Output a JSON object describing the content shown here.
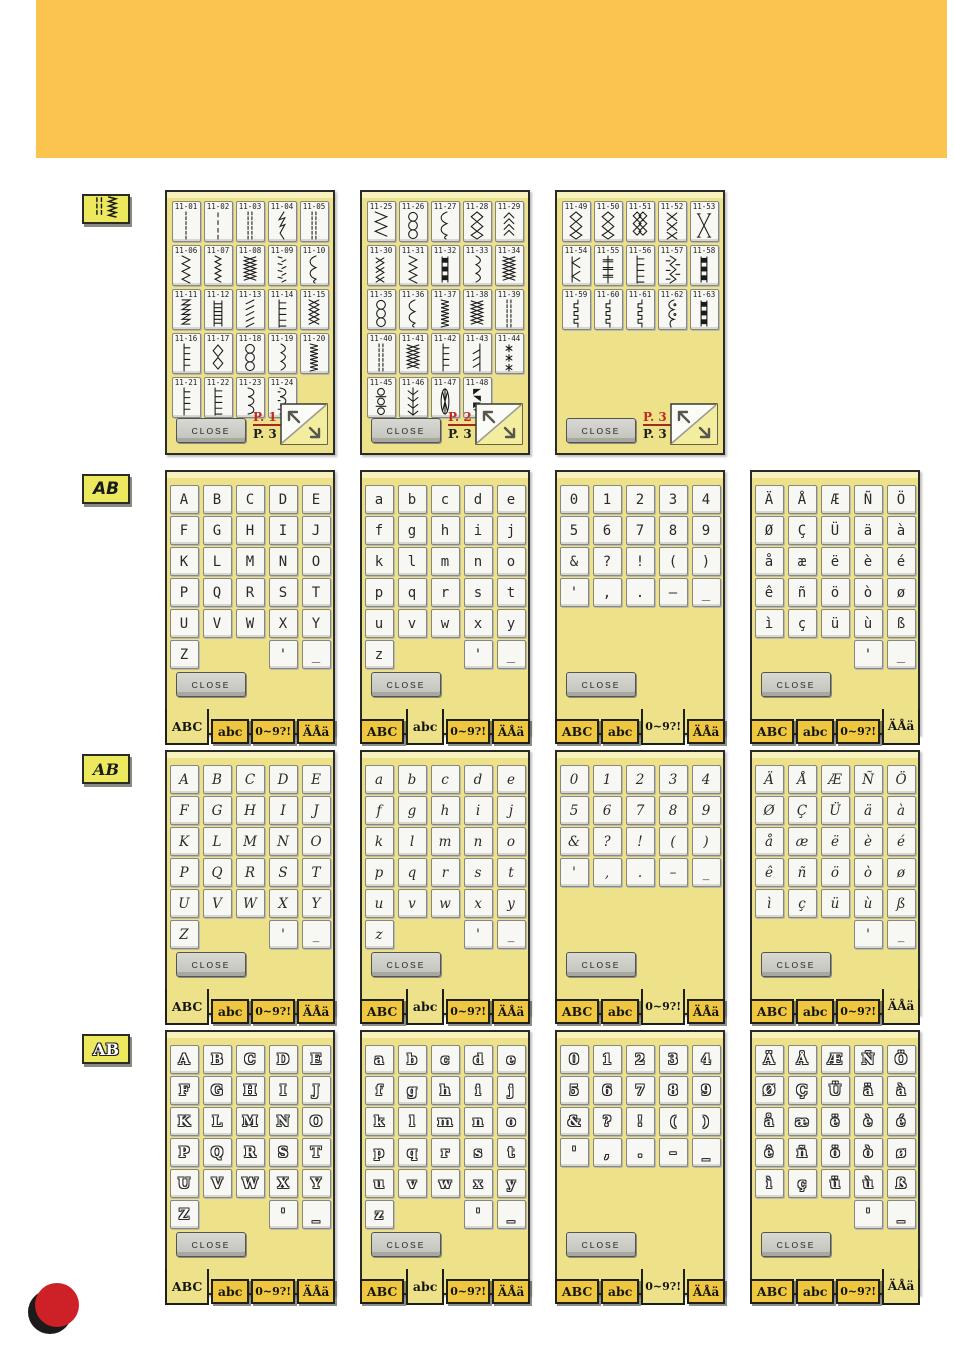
{
  "header": {
    "band_color": "#FAC44F"
  },
  "decoration": {
    "red_dot_color": "#CE2127",
    "shadow_dot_color": "#1d1b1a"
  },
  "common": {
    "close_label": "CLOSE",
    "tabs": [
      "ABC",
      "abc",
      "0~9?!",
      "ÄÅä"
    ],
    "page_total": "P. 3"
  },
  "sidebar": {
    "stitch_button_icon": "stitch-pattern-icon",
    "font_button_label": "AB"
  },
  "font_rows": [
    {
      "id": "block",
      "button_label": "AB"
    },
    {
      "id": "script",
      "button_label": "AB"
    },
    {
      "id": "outline",
      "button_label": "AB"
    }
  ],
  "panel_order": [
    "upper",
    "lower",
    "digits",
    "accents"
  ],
  "charsets": {
    "upper": [
      [
        "A",
        "B",
        "C",
        "D",
        "E"
      ],
      [
        "F",
        "G",
        "H",
        "I",
        "J"
      ],
      [
        "K",
        "L",
        "M",
        "N",
        "O"
      ],
      [
        "P",
        "Q",
        "R",
        "S",
        "T"
      ],
      [
        "U",
        "V",
        "W",
        "X",
        "Y"
      ],
      [
        "Z",
        "",
        "",
        "'",
        "_"
      ]
    ],
    "lower": [
      [
        "a",
        "b",
        "c",
        "d",
        "e"
      ],
      [
        "f",
        "g",
        "h",
        "i",
        "j"
      ],
      [
        "k",
        "l",
        "m",
        "n",
        "o"
      ],
      [
        "p",
        "q",
        "r",
        "s",
        "t"
      ],
      [
        "u",
        "v",
        "w",
        "x",
        "y"
      ],
      [
        "z",
        "",
        "",
        "'",
        "_"
      ]
    ],
    "digits": [
      [
        "0",
        "1",
        "2",
        "3",
        "4"
      ],
      [
        "5",
        "6",
        "7",
        "8",
        "9"
      ],
      [
        "&",
        "?",
        "!",
        "(",
        ")"
      ],
      [
        "'",
        ",",
        ".",
        "–",
        "_"
      ]
    ],
    "accents": [
      [
        "Ä",
        "Å",
        "Æ",
        "Ñ",
        "Ö"
      ],
      [
        "Ø",
        "Ç",
        "Ü",
        "ä",
        "à"
      ],
      [
        "å",
        "æ",
        "ë",
        "è",
        "é"
      ],
      [
        "ê",
        "ñ",
        "ö",
        "ò",
        "ø"
      ],
      [
        "ì",
        "ç",
        "ü",
        "ù",
        "ß"
      ],
      [
        "",
        "",
        "",
        "'",
        "_"
      ]
    ]
  },
  "stitch_pages": [
    {
      "page": "P. 1",
      "stitches": [
        {
          "id": "11-01",
          "glyph": "dash"
        },
        {
          "id": "11-02",
          "glyph": "dashS"
        },
        {
          "id": "11-03",
          "glyph": "dash3"
        },
        {
          "id": "11-04",
          "glyph": "lightning"
        },
        {
          "id": "11-05",
          "glyph": "dash3"
        },
        {
          "id": "11-06",
          "glyph": "zigzag"
        },
        {
          "id": "11-07",
          "glyph": "zigzagS"
        },
        {
          "id": "11-08",
          "glyph": "scribble"
        },
        {
          "id": "11-09",
          "glyph": "dotzig"
        },
        {
          "id": "11-10",
          "glyph": "wave"
        },
        {
          "id": "11-11",
          "glyph": "saw"
        },
        {
          "id": "11-12",
          "glyph": "gridladder"
        },
        {
          "id": "11-13",
          "glyph": "slant"
        },
        {
          "id": "11-14",
          "glyph": "blanket"
        },
        {
          "id": "11-15",
          "glyph": "diamondzig"
        },
        {
          "id": "11-16",
          "glyph": "ladder"
        },
        {
          "id": "11-17",
          "glyph": "diamond"
        },
        {
          "id": "11-18",
          "glyph": "loops"
        },
        {
          "id": "11-19",
          "glyph": "curve"
        },
        {
          "id": "11-20",
          "glyph": "tightzig"
        },
        {
          "id": "11-21",
          "glyph": "ladder"
        },
        {
          "id": "11-22",
          "glyph": "blanket"
        },
        {
          "id": "11-23",
          "glyph": "scallop"
        },
        {
          "id": "11-24",
          "glyph": "scallopD"
        }
      ]
    },
    {
      "page": "P. 2",
      "stitches": [
        {
          "id": "11-25",
          "glyph": "zigzagW"
        },
        {
          "id": "11-26",
          "glyph": "loops"
        },
        {
          "id": "11-27",
          "glyph": "wave"
        },
        {
          "id": "11-28",
          "glyph": "net"
        },
        {
          "id": "11-29",
          "glyph": "chevron"
        },
        {
          "id": "11-30",
          "glyph": "crosszig"
        },
        {
          "id": "11-31",
          "glyph": "zigzag"
        },
        {
          "id": "11-32",
          "glyph": "squares"
        },
        {
          "id": "11-33",
          "glyph": "curve"
        },
        {
          "id": "11-34",
          "glyph": "scribble"
        },
        {
          "id": "11-35",
          "glyph": "loops"
        },
        {
          "id": "11-36",
          "glyph": "wave"
        },
        {
          "id": "11-37",
          "glyph": "tightzig"
        },
        {
          "id": "11-38",
          "glyph": "scribble"
        },
        {
          "id": "11-39",
          "glyph": "dash3"
        },
        {
          "id": "11-40",
          "glyph": "dash3"
        },
        {
          "id": "11-41",
          "glyph": "scribble"
        },
        {
          "id": "11-42",
          "glyph": "ladder"
        },
        {
          "id": "11-43",
          "glyph": "slantline"
        },
        {
          "id": "11-44",
          "glyph": "stars"
        },
        {
          "id": "11-45",
          "glyph": "eyelet"
        },
        {
          "id": "11-46",
          "glyph": "feather"
        },
        {
          "id": "11-47",
          "glyph": "candle"
        },
        {
          "id": "11-48",
          "glyph": "braid"
        }
      ]
    },
    {
      "page": "P. 3",
      "stitches": [
        {
          "id": "11-49",
          "glyph": "net"
        },
        {
          "id": "11-50",
          "glyph": "net"
        },
        {
          "id": "11-51",
          "glyph": "densenet"
        },
        {
          "id": "11-52",
          "glyph": "xx"
        },
        {
          "id": "11-53",
          "glyph": "bigx"
        },
        {
          "id": "11-54",
          "glyph": "arrows"
        },
        {
          "id": "11-55",
          "glyph": "crossladder"
        },
        {
          "id": "11-56",
          "glyph": "blanket"
        },
        {
          "id": "11-57",
          "glyph": "featherzig"
        },
        {
          "id": "11-58",
          "glyph": "squares"
        },
        {
          "id": "11-59",
          "glyph": "step"
        },
        {
          "id": "11-60",
          "glyph": "step"
        },
        {
          "id": "11-61",
          "glyph": "step"
        },
        {
          "id": "11-62",
          "glyph": "scallopchain"
        },
        {
          "id": "11-63",
          "glyph": "squares"
        }
      ]
    }
  ]
}
